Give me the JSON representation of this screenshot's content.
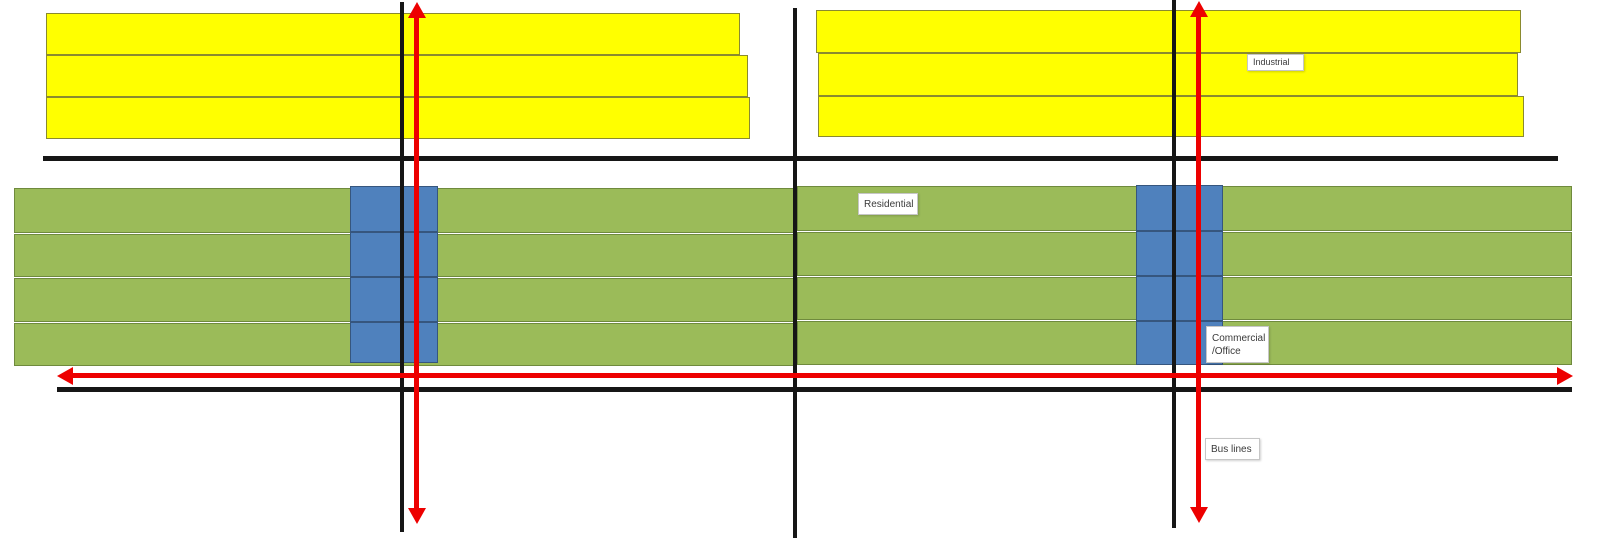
{
  "canvas": {
    "width": 1600,
    "height": 538,
    "background": "#ffffff"
  },
  "palette": {
    "industrial_fill": "#ffff00",
    "industrial_border": "#8a8a2f",
    "residential_fill": "#9bbb59",
    "residential_border": "#6f8a3d",
    "commercial_fill": "#4f81bd",
    "commercial_border": "#36567e",
    "road_color": "#161616",
    "bus_color": "#ed0000",
    "label_bg": "#ffffff",
    "label_border": "#c6c6c6",
    "label_text": "#3a3a3a"
  },
  "industrial_blocks": [
    {
      "x": 46,
      "y": 13,
      "w": 694,
      "h": 42
    },
    {
      "x": 46,
      "y": 55,
      "w": 702,
      "h": 42
    },
    {
      "x": 46,
      "y": 97,
      "w": 704,
      "h": 42
    },
    {
      "x": 816,
      "y": 10,
      "w": 705,
      "h": 43
    },
    {
      "x": 818,
      "y": 53,
      "w": 700,
      "h": 43
    },
    {
      "x": 818,
      "y": 96,
      "w": 706,
      "h": 41
    }
  ],
  "residential_blocks": [
    {
      "x": 14,
      "y": 188,
      "w": 782,
      "h": 45
    },
    {
      "x": 14,
      "y": 234,
      "w": 782,
      "h": 43
    },
    {
      "x": 14,
      "y": 278,
      "w": 782,
      "h": 44
    },
    {
      "x": 14,
      "y": 323,
      "w": 782,
      "h": 43
    },
    {
      "x": 797,
      "y": 186,
      "w": 775,
      "h": 45
    },
    {
      "x": 797,
      "y": 232,
      "w": 775,
      "h": 44
    },
    {
      "x": 797,
      "y": 277,
      "w": 775,
      "h": 43
    },
    {
      "x": 797,
      "y": 321,
      "w": 775,
      "h": 44
    }
  ],
  "commercial_blocks": [
    {
      "x": 350,
      "y": 186,
      "w": 88,
      "h": 46
    },
    {
      "x": 350,
      "y": 232,
      "w": 88,
      "h": 45
    },
    {
      "x": 350,
      "y": 277,
      "w": 88,
      "h": 45
    },
    {
      "x": 350,
      "y": 322,
      "w": 88,
      "h": 41
    },
    {
      "x": 1136,
      "y": 185,
      "w": 87,
      "h": 46
    },
    {
      "x": 1136,
      "y": 231,
      "w": 87,
      "h": 45
    },
    {
      "x": 1136,
      "y": 276,
      "w": 87,
      "h": 45
    },
    {
      "x": 1136,
      "y": 321,
      "w": 87,
      "h": 44
    }
  ],
  "roads": [
    {
      "id": "road-top",
      "x": 43,
      "y": 156,
      "w": 1515,
      "h": 5
    },
    {
      "id": "road-bottom",
      "x": 57,
      "y": 387,
      "w": 1515,
      "h": 5
    },
    {
      "id": "road-vertical-left",
      "x": 400,
      "y": 2,
      "w": 4,
      "h": 530
    },
    {
      "id": "road-vertical-middle",
      "x": 793,
      "y": 8,
      "w": 4,
      "h": 530
    },
    {
      "id": "road-vertical-right",
      "x": 1172,
      "y": 0,
      "w": 4,
      "h": 528
    }
  ],
  "bus_lines": [
    {
      "id": "bus-line-horizontal",
      "orientation": "h",
      "x": 57,
      "y": 373,
      "length": 1516,
      "thickness": 5
    },
    {
      "id": "bus-line-vertical-left",
      "orientation": "v",
      "x": 414,
      "y": 2,
      "length": 522,
      "thickness": 5
    },
    {
      "id": "bus-line-vertical-right",
      "orientation": "v",
      "x": 1196,
      "y": 1,
      "length": 522,
      "thickness": 5
    }
  ],
  "labels": [
    {
      "id": "industrial-label",
      "lines": [
        "Industrial"
      ],
      "x": 1247,
      "y": 54,
      "w": 57,
      "h": 17,
      "font": 9
    },
    {
      "id": "residential-label",
      "lines": [
        "Residential"
      ],
      "x": 858,
      "y": 193,
      "w": 60,
      "h": 22,
      "font": 10
    },
    {
      "id": "commercial-office-label",
      "lines": [
        "Commercial",
        "/Office"
      ],
      "x": 1206,
      "y": 326,
      "w": 63,
      "h": 37,
      "font": 10
    },
    {
      "id": "bus-lines-label",
      "lines": [
        "Bus lines"
      ],
      "x": 1205,
      "y": 438,
      "w": 55,
      "h": 22,
      "font": 10
    }
  ]
}
